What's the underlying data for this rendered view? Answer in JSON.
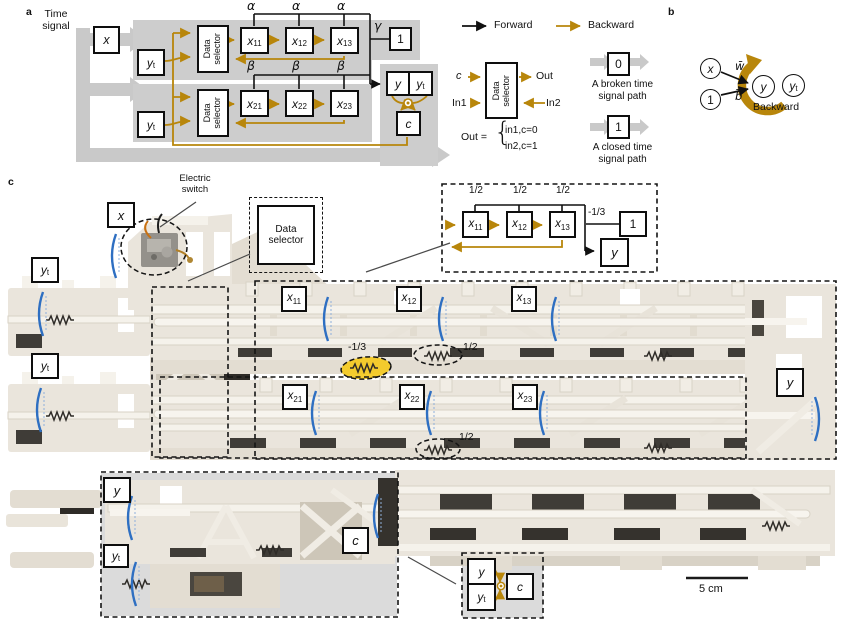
{
  "panel_a": {
    "label": "a",
    "time_signal": [
      "Time",
      "signal"
    ],
    "data_selector": [
      "Data",
      "selector"
    ],
    "alpha": "α",
    "beta": "β",
    "gamma": "γ",
    "x": "x",
    "one": "1",
    "y": "y",
    "c": "c",
    "yt": {
      "b": "y",
      "s": "t"
    },
    "x11": {
      "b": "x",
      "s": "11"
    },
    "x12": {
      "b": "x",
      "s": "12"
    },
    "x13": {
      "b": "x",
      "s": "13"
    },
    "x21": {
      "b": "x",
      "s": "21"
    },
    "x22": {
      "b": "x",
      "s": "22"
    },
    "x23": {
      "b": "x",
      "s": "23"
    }
  },
  "legend": {
    "forward": "Forward",
    "backward": "Backward",
    "ds_label": [
      "Data",
      "selector"
    ],
    "c": "c",
    "in1": "In1",
    "in2": "In2",
    "out": "Out",
    "out_eq": "Out =",
    "brace": "{",
    "case0": "in1,c=0",
    "case1": "in2,c=1",
    "zero": "0",
    "one": "1",
    "broken": [
      "A broken time",
      "signal path"
    ],
    "closed": [
      "A closed time",
      "signal path"
    ]
  },
  "panel_b": {
    "label": "b",
    "x": "x",
    "one": "1",
    "y": "y",
    "yt": {
      "b": "y",
      "s": "t"
    },
    "w": "w̄",
    "bias": "b̄",
    "backward": "Backward"
  },
  "panel_c": {
    "label": "c",
    "electric_switch": [
      "Electric",
      "switch"
    ],
    "data_selector": [
      "Data",
      "selector"
    ],
    "x": "x",
    "y": "y",
    "c": "c",
    "yt": {
      "b": "y",
      "s": "t"
    },
    "x11": {
      "b": "x",
      "s": "11"
    },
    "x12": {
      "b": "x",
      "s": "12"
    },
    "x13": {
      "b": "x",
      "s": "13"
    },
    "x21": {
      "b": "x",
      "s": "21"
    },
    "x22": {
      "b": "x",
      "s": "22"
    },
    "x23": {
      "b": "x",
      "s": "23"
    },
    "neg_third": "-1/3",
    "half": "1/2",
    "inset": {
      "half1": "1/2",
      "half2": "1/2",
      "half3": "1/2",
      "neg_third": "-1/3",
      "one": "1",
      "y": "y",
      "x11": {
        "b": "x",
        "s": "11"
      },
      "x12": {
        "b": "x",
        "s": "12"
      },
      "x13": {
        "b": "x",
        "s": "13"
      }
    },
    "inset_yc": {
      "y": "y",
      "yt": {
        "b": "y",
        "s": "t"
      },
      "c": "c"
    },
    "scale_bar": "5 cm"
  },
  "colors": {
    "backward_gold": "#B8860B",
    "path_gray": "#C9C9C9",
    "highlight_yellow": "#F4C91E",
    "pointer_blue": "#2E6FC2"
  }
}
